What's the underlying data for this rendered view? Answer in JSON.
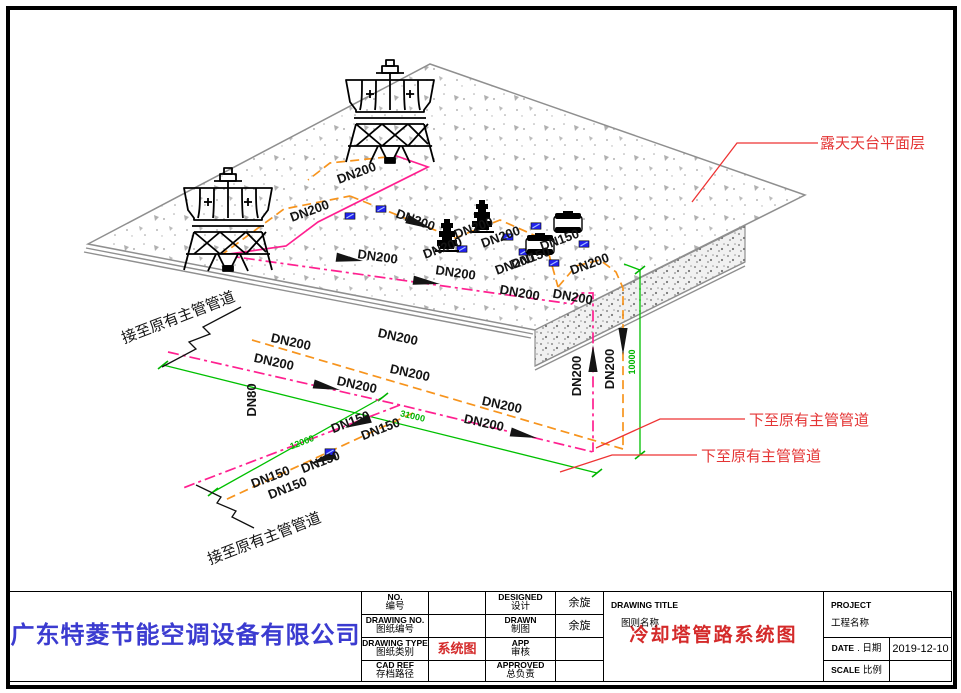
{
  "colors": {
    "pipe_orange": "#f7941d",
    "pipe_magenta": "#ff2090",
    "dim_green": "#00b400",
    "annotation_red": "#e43535",
    "valve_blue": "#2222ee",
    "company_blue": "#3b3bd0",
    "title_red": "#d42a2a"
  },
  "annotations": {
    "roof_label": "露天天台平面层",
    "down_to_main_1": "下至原有主管管道",
    "down_to_main_2": "下至原有主管管道",
    "connect_main_upper": "接至原有主管管道",
    "connect_main_lower": "接至原有主管管道"
  },
  "pipe_labels": [
    {
      "t": "DN200",
      "x": 358,
      "y": 177,
      "r": -20
    },
    {
      "t": "DN200",
      "x": 311,
      "y": 215,
      "r": -20
    },
    {
      "t": "DN200",
      "x": 414,
      "y": 224,
      "r": 20
    },
    {
      "t": "DN200",
      "x": 377,
      "y": 261,
      "r": 8
    },
    {
      "t": "DN200",
      "x": 455,
      "y": 277,
      "r": 8
    },
    {
      "t": "DN200",
      "x": 444,
      "y": 252,
      "r": -20
    },
    {
      "t": "DN200",
      "x": 475,
      "y": 232,
      "r": -20
    },
    {
      "t": "DN200",
      "x": 502,
      "y": 241,
      "r": -20
    },
    {
      "t": "DN200",
      "x": 516,
      "y": 268,
      "r": -20
    },
    {
      "t": "DN150",
      "x": 561,
      "y": 244,
      "r": -20
    },
    {
      "t": "DN150",
      "x": 532,
      "y": 262,
      "r": -20
    },
    {
      "t": "DN200",
      "x": 519,
      "y": 297,
      "r": 10
    },
    {
      "t": "DN200",
      "x": 572,
      "y": 301,
      "r": 10
    },
    {
      "t": "DN200",
      "x": 591,
      "y": 268,
      "r": -20
    },
    {
      "t": "DN200",
      "x": 581,
      "y": 376,
      "r": -90
    },
    {
      "t": "DN200",
      "x": 614,
      "y": 369,
      "r": -90
    },
    {
      "t": "DN200",
      "x": 290,
      "y": 346,
      "r": 12
    },
    {
      "t": "DN200",
      "x": 273,
      "y": 366,
      "r": 12
    },
    {
      "t": "DN200",
      "x": 397,
      "y": 341,
      "r": 12
    },
    {
      "t": "DN200",
      "x": 409,
      "y": 377,
      "r": 12
    },
    {
      "t": "DN200",
      "x": 356,
      "y": 389,
      "r": 12
    },
    {
      "t": "DN200",
      "x": 501,
      "y": 409,
      "r": 12
    },
    {
      "t": "DN200",
      "x": 483,
      "y": 427,
      "r": 12
    },
    {
      "t": "DN150",
      "x": 352,
      "y": 426,
      "r": -21
    },
    {
      "t": "DN150",
      "x": 382,
      "y": 433,
      "r": -21
    },
    {
      "t": "DN150",
      "x": 322,
      "y": 466,
      "r": -21
    },
    {
      "t": "DN150",
      "x": 272,
      "y": 481,
      "r": -21
    },
    {
      "t": "DN150",
      "x": 289,
      "y": 492,
      "r": -21
    },
    {
      "t": "DN80",
      "x": 256,
      "y": 400,
      "r": -90
    }
  ],
  "dim_labels": [
    {
      "t": "12000",
      "x": 303,
      "y": 445,
      "r": -21
    },
    {
      "t": "31000",
      "x": 412,
      "y": 419,
      "r": 13
    },
    {
      "t": "10000",
      "x": 635,
      "y": 362,
      "r": -90
    }
  ],
  "title_block": {
    "company": "广东特菱节能空调设备有限公司",
    "rows": [
      {
        "label_en": "NO.",
        "label_cn": "编号",
        "value": "",
        "mid_en": "DESIGNED",
        "mid_cn": "设计",
        "name": "余旋"
      },
      {
        "label_en": "DRAWING NO.",
        "label_cn": "图纸编号",
        "value": "",
        "mid_en": "DRAWN",
        "mid_cn": "制图",
        "name": "余旋"
      },
      {
        "label_en": "DRAWING TYPE",
        "label_cn": "图纸类别",
        "value": "系统图",
        "mid_en": "APP",
        "mid_cn": "审核",
        "name": ""
      },
      {
        "label_en": "CAD REF",
        "label_cn": "存档路径",
        "value": "",
        "mid_en": "APPROVED",
        "mid_cn": "总负责",
        "name": ""
      }
    ],
    "drawing_title_en": "DRAWING TITLE",
    "drawing_title_cn": "图则名称",
    "drawing_title_value": "冷却塔管路系统图",
    "project_en": "PROJECT",
    "project_cn": "工程名称",
    "project_value": "",
    "date_en": "DATE",
    "date_cn": ". 日期",
    "date_value": "2019-12-10",
    "scale_en": "SCALE",
    "scale_cn": "比例",
    "scale_value": ""
  }
}
